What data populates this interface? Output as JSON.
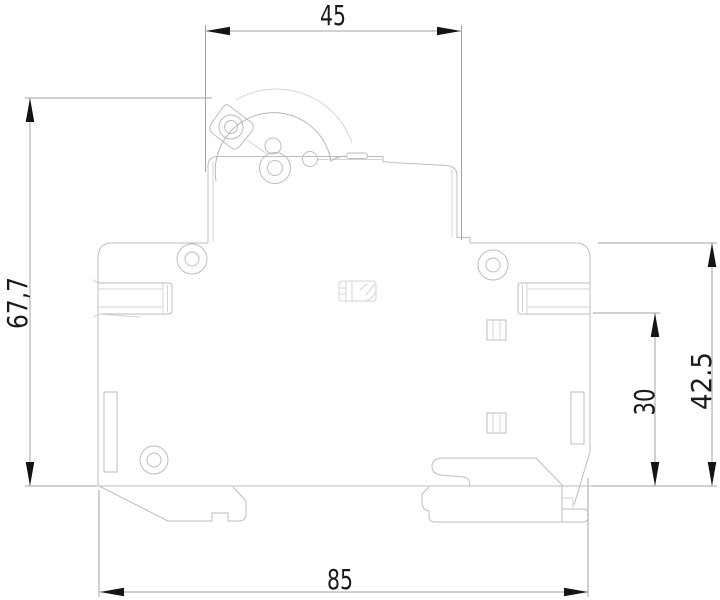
{
  "drawing": {
    "type": "technical-dimension-drawing",
    "subject": "miniature-circuit-breaker-side-profile",
    "background": "#ffffff",
    "colors": {
      "outline": "#bdbdbd",
      "outline_faint": "#d4d4d4",
      "dimension_line": "#a3a3a3",
      "arrowhead": "#141414",
      "text": "#1a1a1a"
    },
    "dimensions": [
      {
        "id": "top-width",
        "label": "45",
        "orientation": "horizontal",
        "position": "top"
      },
      {
        "id": "left-height",
        "label": "67,7",
        "orientation": "vertical",
        "position": "left"
      },
      {
        "id": "right-height-total",
        "label": "42.5",
        "orientation": "vertical",
        "position": "right-outer"
      },
      {
        "id": "right-height-inner",
        "label": "30",
        "orientation": "vertical",
        "position": "right-inner"
      },
      {
        "id": "bottom-width",
        "label": "85",
        "orientation": "horizontal",
        "position": "bottom"
      }
    ]
  }
}
